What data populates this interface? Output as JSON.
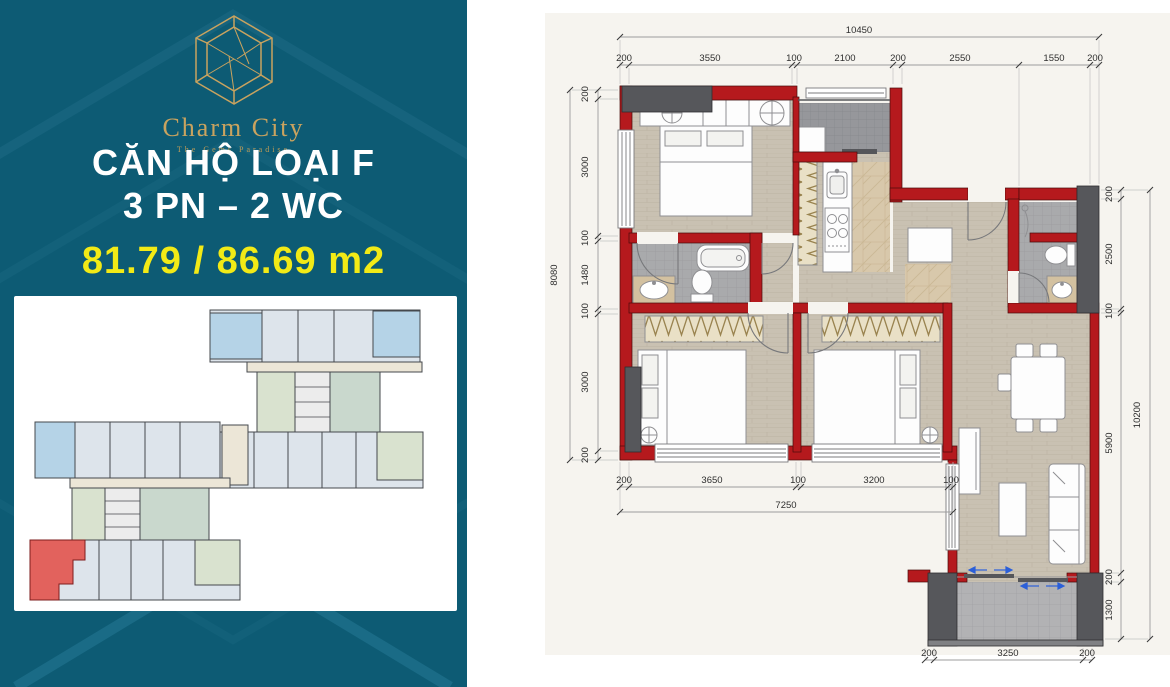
{
  "left_panel": {
    "brand": "Charm City",
    "tagline": "The Gems Paradise",
    "title_line1": "CĂN HỘ LOẠI F",
    "title_line2": "3 PN – 2 WC",
    "area_text": "81.79 / 86.69 m2",
    "colors": {
      "background_teal": "#0d5b74",
      "brand_gold": "#c9a35f",
      "area_yellow": "#f2ea16",
      "keyplan_highlight_red": "#e2625d"
    }
  },
  "floor_plan": {
    "colors": {
      "wall_red": "#b5191d",
      "column_gray": "#56575b",
      "floor_wood": "#c9c1b2",
      "wet_tile_gray": "#a9aaac",
      "paper": "#f6f4ef"
    },
    "dimensions": {
      "top_total": "10450",
      "top_segments": [
        "200",
        "3550",
        "100",
        "2100",
        "200",
        "2550",
        "1550",
        "200"
      ],
      "left_total": "8080",
      "left_segments": [
        "200",
        "3000",
        "100",
        "1480",
        "100",
        "3000",
        "200"
      ],
      "right_total": "10200",
      "right_segments": [
        "200",
        "2500",
        "100",
        "5900",
        "200",
        "1300"
      ],
      "bottom_inner_total": "7250",
      "bottom_inner_segments": [
        "200",
        "3650",
        "100",
        "3200",
        "100"
      ],
      "bottom_outer_segments": [
        "200",
        "3250",
        "200"
      ]
    }
  }
}
